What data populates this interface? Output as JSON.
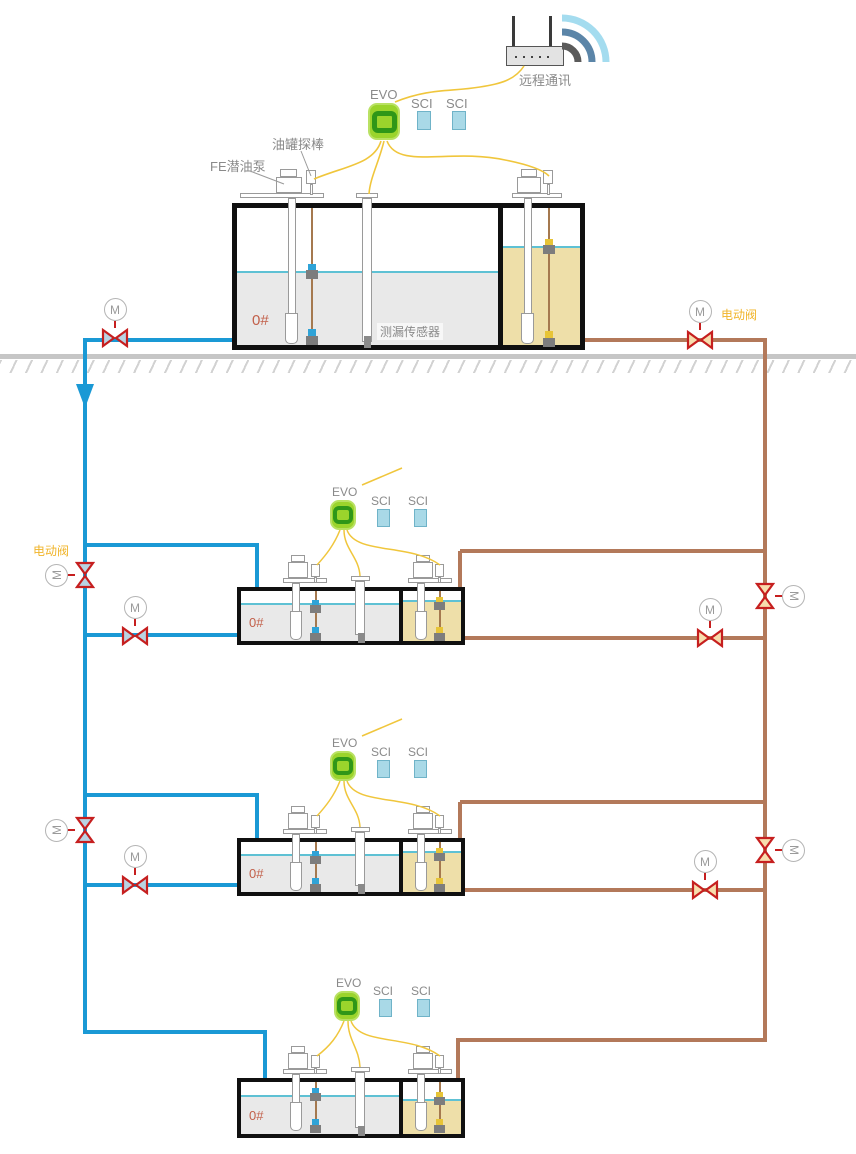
{
  "labels": {
    "remote_comm": "远程通讯",
    "tank_probe": "油罐探棒",
    "submersible_pump": "FE潜油泵",
    "leak_sensor": "测漏传感器",
    "electric_valve": "电动阀",
    "motor": "M"
  },
  "tanks": [
    {
      "grade": "0#",
      "evo": "EVO",
      "sci": [
        "SCI",
        "SCI"
      ]
    },
    {
      "grade": "0#",
      "evo": "EVO",
      "sci": [
        "SCI",
        "SCI"
      ]
    },
    {
      "grade": "0#",
      "evo": "EVO",
      "sci": [
        "SCI",
        "SCI"
      ]
    },
    {
      "grade": "0#",
      "evo": "EVO",
      "sci": [
        "SCI",
        "SCI"
      ]
    }
  ],
  "colors": {
    "supply_pipe_blue": "#1a99d5",
    "return_pipe_brown": "#b3795a",
    "valve_red": "#c61f1f",
    "wire_yellow": "#f0c63c",
    "evo_green": "#9bd42c",
    "sci_blue": "#a9d9e7",
    "diesel_liquid_gray": "#e9e9e9",
    "fuel_liquid_tan": "#eedfa9",
    "valve_label_orange": "#f0b42a",
    "grade_label_red": "#c2604a"
  }
}
